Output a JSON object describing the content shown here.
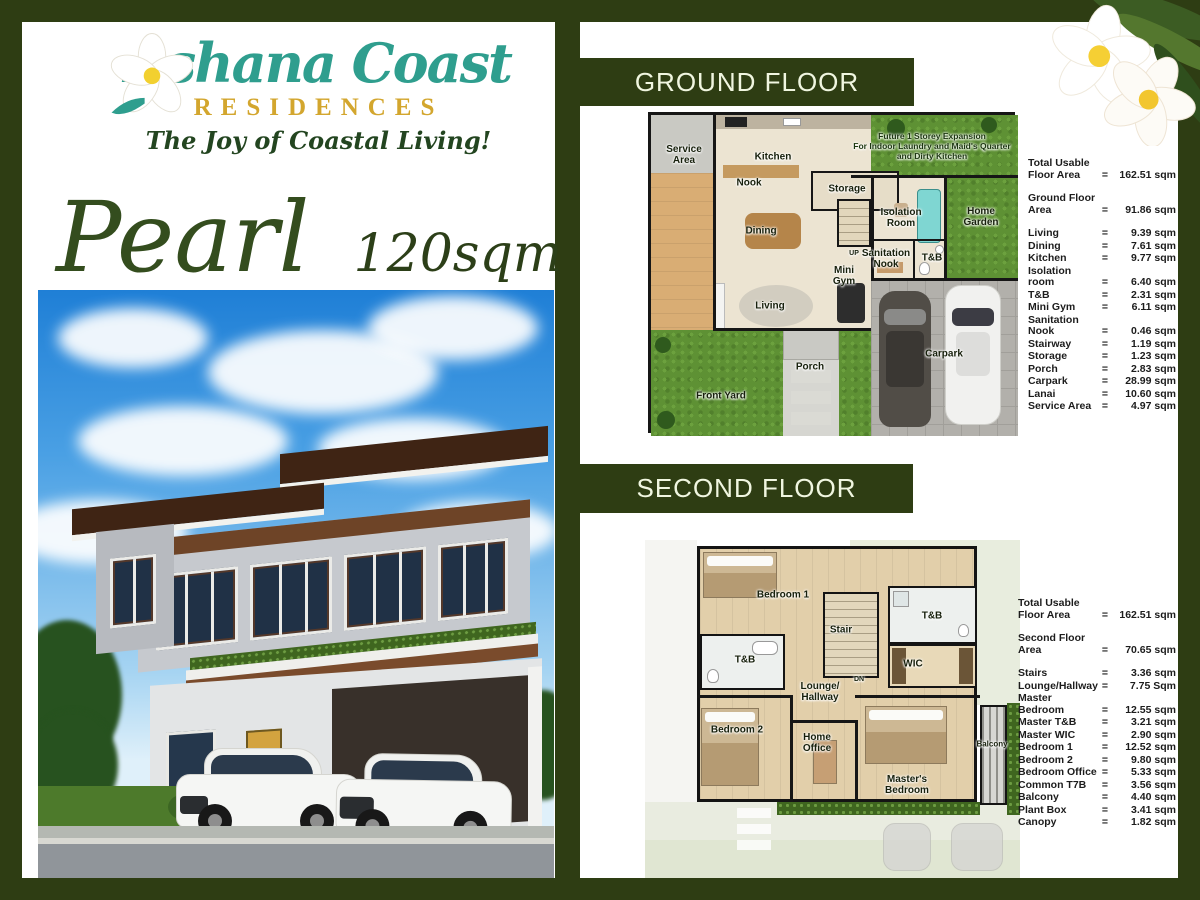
{
  "brand": {
    "script_name": "Ashana Coast",
    "residences": "RESIDENCES",
    "tagline": "The Joy of Coastal Living!"
  },
  "model": {
    "name": "Pearl",
    "size": "120sqm"
  },
  "misc": {
    "eq": "="
  },
  "colors": {
    "frame_green": "#2e3d13",
    "logo_teal": "#2f9e8e",
    "logo_gold": "#d3a62e",
    "title_green": "#344d1e"
  },
  "ground": {
    "header": "GROUND FLOOR",
    "plan": {
      "labels": [
        {
          "text": "Service\nArea",
          "x": 33,
          "y": 40
        },
        {
          "text": "Kitchen",
          "x": 122,
          "y": 42
        },
        {
          "text": "Nook",
          "x": 98,
          "y": 68
        },
        {
          "text": "Storage",
          "x": 196,
          "y": 74
        },
        {
          "text": "Dining",
          "x": 110,
          "y": 116
        },
        {
          "text": "Isolation\nRoom",
          "x": 250,
          "y": 103
        },
        {
          "text": "Home\nGarden",
          "x": 330,
          "y": 102
        },
        {
          "text": "Sanitation\nNook",
          "x": 235,
          "y": 144
        },
        {
          "text": "T&B",
          "x": 281,
          "y": 143
        },
        {
          "text": "Mini\nGym",
          "x": 193,
          "y": 161
        },
        {
          "text": "Living",
          "x": 119,
          "y": 191
        },
        {
          "text": "Porch",
          "x": 159,
          "y": 252
        },
        {
          "text": "Front Yard",
          "x": 70,
          "y": 281
        },
        {
          "text": "Carpark",
          "x": 293,
          "y": 239
        },
        {
          "text": "UP",
          "x": 203,
          "y": 139,
          "cls": "tiny"
        },
        {
          "text": "Future 1 Storey Expansion\nFor Indoor Laundry and Maid's Quarter\nand Dirty Kitchen",
          "x": 281,
          "y": 31,
          "cls": "note"
        }
      ]
    },
    "table": {
      "rows": [
        {
          "label": "Total Usable Floor Area",
          "value": "162.51 sqm",
          "cls": "gap"
        },
        {
          "label": "Ground Floor Area",
          "value": "91.86 sqm",
          "cls": "gap"
        },
        {
          "label": "Living",
          "value": "9.39 sqm"
        },
        {
          "label": "Dining",
          "value": "7.61 sqm"
        },
        {
          "label": "Kitchen",
          "value": "9.77 sqm"
        },
        {
          "label": "Isolation room",
          "value": "6.40 sqm"
        },
        {
          "label": "T&B",
          "value": "2.31 sqm"
        },
        {
          "label": "Mini Gym",
          "value": "6.11 sqm"
        },
        {
          "label": "Sanitation Nook",
          "value": "0.46 sqm"
        },
        {
          "label": "Stairway",
          "value": "1.19 sqm"
        },
        {
          "label": "Storage",
          "value": "1.23 sqm"
        },
        {
          "label": "Porch",
          "value": "2.83 sqm"
        },
        {
          "label": "Carpark",
          "value": "28.99 sqm"
        },
        {
          "label": "Lanai",
          "value": "10.60 sqm"
        },
        {
          "label": "Service Area",
          "value": "4.97 sqm"
        }
      ]
    }
  },
  "second": {
    "header": "SECOND FLOOR",
    "plan": {
      "labels": [
        {
          "text": "Bedroom 1",
          "x": 138,
          "y": 55
        },
        {
          "text": "Stair",
          "x": 196,
          "y": 90
        },
        {
          "text": "T&B",
          "x": 287,
          "y": 76
        },
        {
          "text": "WIC",
          "x": 268,
          "y": 124
        },
        {
          "text": "T&B",
          "x": 100,
          "y": 120
        },
        {
          "text": "Lounge/\nHallway",
          "x": 175,
          "y": 152
        },
        {
          "text": "Bedroom 2",
          "x": 92,
          "y": 190
        },
        {
          "text": "Home\nOffice",
          "x": 172,
          "y": 203
        },
        {
          "text": "Master's\nBedroom",
          "x": 262,
          "y": 245
        },
        {
          "text": "Balcony",
          "x": 347,
          "y": 204,
          "cls": "small"
        },
        {
          "text": "DN",
          "x": 214,
          "y": 140,
          "cls": "tiny"
        }
      ]
    },
    "table": {
      "rows": [
        {
          "label": "Total Usable Floor Area",
          "value": "162.51 sqm",
          "cls": "gap"
        },
        {
          "label": "Second Floor Area",
          "value": "70.65 sqm",
          "cls": "gap"
        },
        {
          "label": "Stairs",
          "value": "3.36 sqm"
        },
        {
          "label": "Lounge/Hallway",
          "value": "7.75 Sqm"
        },
        {
          "label": "Master Bedroom",
          "value": "12.55 sqm"
        },
        {
          "label": "Master T&B",
          "value": "3.21 sqm"
        },
        {
          "label": "Master WIC",
          "value": "2.90 sqm"
        },
        {
          "label": "Bedroom 1",
          "value": "12.52 sqm"
        },
        {
          "label": "Bedroom 2",
          "value": "9.80 sqm"
        },
        {
          "label": "Bedroom Office",
          "value": "5.33 sqm"
        },
        {
          "label": "Common T7B",
          "value": "3.56 sqm"
        },
        {
          "label": "Balcony",
          "value": "4.40 sqm"
        },
        {
          "label": "Plant Box",
          "value": "3.41 sqm"
        },
        {
          "label": "Canopy",
          "value": "1.82 sqm"
        }
      ]
    }
  }
}
